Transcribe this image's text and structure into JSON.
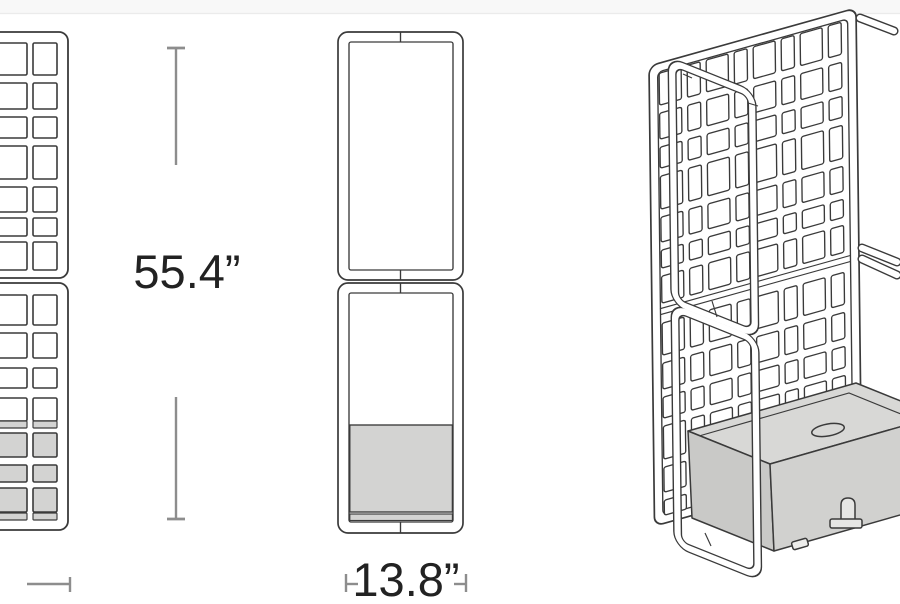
{
  "diagram": {
    "title": "trellis-planter dimension drawing",
    "views": {
      "front": "front view (cropped at left edge)",
      "side": "side view",
      "iso": "isometric view (cropped at right edge)"
    }
  },
  "dimensions": {
    "height_label": "55.4”",
    "width_label": "13.8”"
  },
  "colors": {
    "line": "#3a3a3a",
    "dimension": "#8d8d8d",
    "label": "#222222",
    "panel_fill": "#ffffff",
    "planter_fill": "#d3d3d2",
    "planter_top": "#d8d8d6",
    "planter_front": "#d1d1cf",
    "planter_side": "#c9c9c7",
    "background": "#ffffff",
    "artifact_line": "#ebebeb",
    "artifact_band": "#f8f8f8"
  }
}
